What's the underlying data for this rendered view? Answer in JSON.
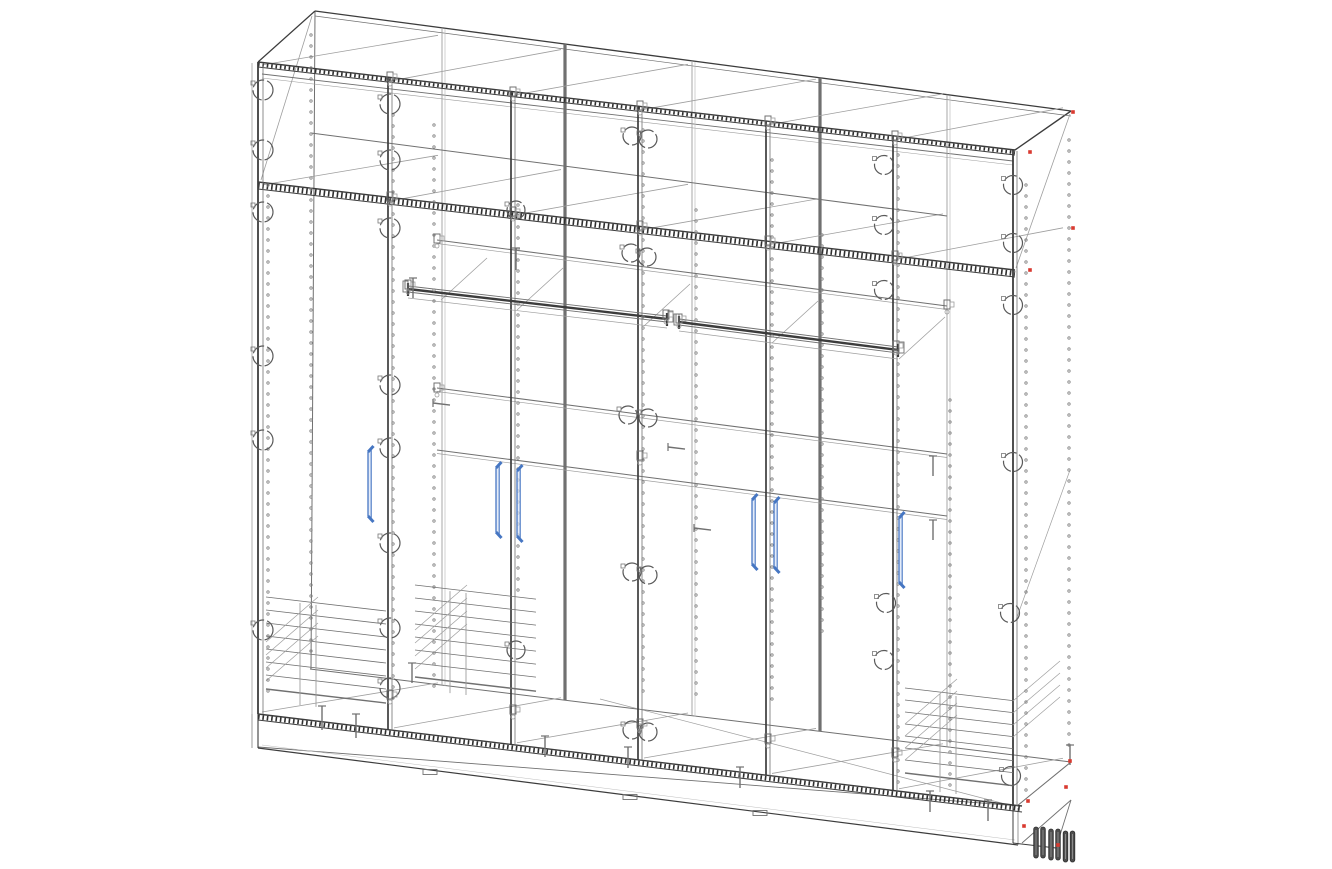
{
  "meta": {
    "kind": "cad-wireframe-drawing",
    "subject": "six-section wardrobe carcass, isometric wireframe view",
    "background": "#ffffff"
  },
  "palette": {
    "dark": "#3c3c3c",
    "mid": "#707070",
    "light": "#9e9e9e",
    "faint": "#bfbfbf",
    "hatch": "#2f2f2f",
    "blue": "#4676c2",
    "blue_fill": "#d8e4f6",
    "red": "#d93a30",
    "leg": "#4e4e4e",
    "leg_edge": "#2e2e2e"
  },
  "proj": {
    "x0": 258,
    "x1": 1015,
    "yTop": 62,
    "yMezz": 182,
    "yBot": 714,
    "yBase": 748,
    "sTop": 0.116,
    "sBot": 0.1205,
    "sBase": 0.128,
    "back": {
      "xL": 315,
      "yTL": 11,
      "xR": 1071,
      "yTR": 111,
      "yBL": 669,
      "yBR": 762
    }
  },
  "partitions": [
    390,
    513,
    640,
    768,
    895
  ],
  "back_edges": [
    {
      "x": 442,
      "w": 0.9,
      "double": true
    },
    {
      "x": 565,
      "w": 3.2,
      "double": false
    },
    {
      "x": 692,
      "w": 0.9,
      "double": true
    },
    {
      "x": 820,
      "w": 3.2,
      "double": false
    },
    {
      "x": 947,
      "w": 0.9,
      "double": true
    }
  ],
  "bands": [
    {
      "x1": 258,
      "y1": 62,
      "x2": 1015,
      "y2": 150,
      "gap": 5
    },
    {
      "x1": 258,
      "y1": 182,
      "x2": 1015,
      "y2": 270,
      "gap": 7
    },
    {
      "x1": 258,
      "y1": 714,
      "x2": 1022,
      "y2": 806,
      "gap": 6
    }
  ],
  "shelves": [
    {
      "x1": 437,
      "y1": 240,
      "x2": 947,
      "y2": 306,
      "double": true
    },
    {
      "x1": 437,
      "y1": 388,
      "x2": 947,
      "y2": 454,
      "double": true
    },
    {
      "x1": 437,
      "y1": 450,
      "x2": 947,
      "y2": 516,
      "double": true
    },
    {
      "x1": 311,
      "y1": 133,
      "x2": 947,
      "y2": 216,
      "double": false
    }
  ],
  "rails": [
    {
      "x1": 408,
      "y1": 289,
      "x2": 667,
      "y2": 319
    },
    {
      "x1": 679,
      "y1": 322,
      "x2": 898,
      "y2": 350
    }
  ],
  "extra_lines": [
    [
      252,
      63,
      252,
      714,
      0.8,
      "light"
    ],
    [
      315,
      11,
      311,
      669,
      1.0,
      "mid"
    ],
    [
      261,
      180,
      312,
      16,
      0.8,
      "light"
    ],
    [
      258,
      62,
      315,
      11,
      1.2,
      "dark"
    ],
    [
      1015,
      150,
      1071,
      111,
      1.4,
      "dark"
    ],
    [
      315,
      11,
      1071,
      111,
      1.3,
      "dark"
    ],
    [
      315,
      16,
      1071,
      116,
      0.7,
      "mid"
    ],
    [
      310,
      669,
      1071,
      762,
      1.0,
      "mid"
    ],
    [
      258,
      747,
      1020,
      806,
      0.9,
      "mid"
    ],
    [
      600,
      699,
      1013,
      806,
      0.7,
      "light"
    ],
    [
      1017,
      806,
      1071,
      762,
      1.1,
      "mid"
    ],
    [
      1022,
      843,
      1071,
      800,
      0.9,
      "mid"
    ],
    [
      1016,
      268,
      1070,
      114,
      0.8,
      "light"
    ],
    [
      1016,
      620,
      1070,
      470,
      0.7,
      "light"
    ],
    [
      262,
      74,
      1013,
      161,
      0.9,
      "mid"
    ],
    [
      262,
      78,
      1013,
      165,
      0.6,
      "light"
    ],
    [
      258,
      714,
      258,
      748,
      1.1,
      "dark"
    ],
    [
      252,
      714,
      252,
      748,
      0.7,
      "mid"
    ],
    [
      258,
      748,
      1018,
      845,
      1.2,
      "dark"
    ],
    [
      262,
      745,
      1015,
      840,
      0.5,
      "faint"
    ],
    [
      1013,
      806,
      1013,
      843,
      1.0,
      "dark"
    ],
    [
      1018,
      808,
      1018,
      845,
      0.7,
      "mid"
    ],
    [
      1013,
      843,
      1056,
      848,
      1.0,
      "dark"
    ],
    [
      1056,
      848,
      1071,
      800,
      0.9,
      "mid"
    ]
  ],
  "front_edges": [
    {
      "x": 258,
      "yA": 62,
      "yB": 714
    },
    {
      "x": 1013,
      "yA": 150,
      "yB": 806
    }
  ],
  "handles": [
    {
      "x": 368,
      "y1": 452,
      "y2": 516
    },
    {
      "x": 496,
      "y1": 468,
      "y2": 532
    },
    {
      "x": 517,
      "y1": 471,
      "y2": 536
    },
    {
      "x": 752,
      "y1": 500,
      "y2": 564
    },
    {
      "x": 774,
      "y1": 503,
      "y2": 567
    },
    {
      "x": 899,
      "y1": 518,
      "y2": 582
    }
  ],
  "circles": [
    [
      263,
      90,
      10
    ],
    [
      263,
      150,
      10
    ],
    [
      263,
      212,
      10
    ],
    [
      263,
      356,
      10
    ],
    [
      263,
      440,
      10
    ],
    [
      263,
      630,
      10
    ],
    [
      390,
      104,
      10
    ],
    [
      390,
      160,
      10
    ],
    [
      390,
      228,
      10
    ],
    [
      390,
      385,
      10
    ],
    [
      390,
      448,
      10
    ],
    [
      390,
      543,
      10
    ],
    [
      390,
      628,
      10
    ],
    [
      390,
      688,
      10
    ],
    [
      516,
      210,
      9
    ],
    [
      516,
      650,
      9
    ],
    [
      632,
      136,
      9
    ],
    [
      648,
      139,
      9
    ],
    [
      631,
      253,
      9
    ],
    [
      647,
      257,
      9
    ],
    [
      628,
      415,
      9
    ],
    [
      648,
      418,
      9
    ],
    [
      632,
      572,
      9
    ],
    [
      648,
      575,
      9
    ],
    [
      632,
      730,
      9
    ],
    [
      648,
      732,
      9
    ],
    [
      884,
      165,
      9.5
    ],
    [
      884,
      225,
      9.5
    ],
    [
      884,
      290,
      9.5
    ],
    [
      886,
      603,
      9.5
    ],
    [
      884,
      660,
      9.5
    ],
    [
      1013,
      185,
      9.5
    ],
    [
      1013,
      243,
      9.5
    ],
    [
      1013,
      305,
      9.5
    ],
    [
      1013,
      462,
      9.5
    ],
    [
      1010,
      613,
      9.5
    ],
    [
      1011,
      776,
      9.5
    ]
  ],
  "hole_columns": [
    [
      268,
      185,
      700
    ],
    [
      311,
      35,
      655
    ],
    [
      393,
      115,
      700
    ],
    [
      434,
      125,
      695
    ],
    [
      518,
      205,
      595
    ],
    [
      643,
      130,
      700
    ],
    [
      696,
      210,
      700
    ],
    [
      772,
      160,
      700
    ],
    [
      822,
      235,
      640
    ],
    [
      898,
      155,
      790
    ],
    [
      950,
      400,
      785
    ],
    [
      1026,
      185,
      790
    ],
    [
      1069,
      140,
      750
    ]
  ],
  "hole_step": 11,
  "pins_v": [
    [
      322,
      706,
      730
    ],
    [
      356,
      714,
      738
    ],
    [
      413,
      278,
      298
    ],
    [
      516,
      248,
      270
    ],
    [
      412,
      663,
      683
    ],
    [
      545,
      736,
      757
    ],
    [
      628,
      747,
      768
    ],
    [
      740,
      767,
      788
    ],
    [
      930,
      791,
      812
    ],
    [
      988,
      800,
      821
    ],
    [
      1070,
      745,
      765
    ],
    [
      933,
      456,
      476
    ],
    [
      933,
      520,
      540
    ]
  ],
  "pins_h": [
    [
      433,
      403,
      17
    ],
    [
      668,
      447,
      17
    ],
    [
      694,
      528,
      17
    ]
  ],
  "clips": [
    [
      430,
      772
    ],
    [
      630,
      797
    ],
    [
      760,
      813
    ]
  ],
  "fittings": [
    [
      390,
      77
    ],
    [
      513,
      92
    ],
    [
      640,
      106
    ],
    [
      768,
      121
    ],
    [
      895,
      136
    ],
    [
      390,
      197
    ],
    [
      513,
      212
    ],
    [
      640,
      226
    ],
    [
      768,
      241
    ],
    [
      895,
      256
    ],
    [
      408,
      285
    ],
    [
      666,
      315
    ],
    [
      679,
      319
    ],
    [
      896,
      346
    ],
    [
      437,
      239
    ],
    [
      947,
      305
    ],
    [
      437,
      388
    ],
    [
      640,
      456
    ],
    [
      390,
      695
    ],
    [
      513,
      710
    ],
    [
      640,
      724
    ],
    [
      768,
      739
    ],
    [
      895,
      753
    ]
  ],
  "braces_A": [
    [
      437,
      242
    ],
    [
      513,
      252
    ],
    [
      640,
      268
    ],
    [
      768,
      285
    ],
    [
      895,
      301
    ]
  ],
  "baskets": [
    {
      "x1": 266,
      "x2": 386,
      "y0": 597,
      "step": 13,
      "n": 7,
      "verts": [
        300,
        316
      ],
      "vlen": 102,
      "diags": 4,
      "dy0": 45
    },
    {
      "x1": 415,
      "x2": 536,
      "y0": 585,
      "step": 13,
      "n": 7,
      "verts": [
        450,
        466
      ],
      "vlen": 102,
      "diags": 4,
      "dy0": 45
    },
    {
      "x1": 905,
      "x2": 1013,
      "y0": 688,
      "step": 12,
      "n": 7,
      "verts": [
        940,
        956
      ],
      "vlen": 98,
      "diags": 4,
      "dy0": 36
    }
  ],
  "red_dots": [
    [
      1030,
      152
    ],
    [
      1073,
      112
    ],
    [
      1030,
      270
    ],
    [
      1073,
      228
    ],
    [
      1070,
      761
    ],
    [
      1066,
      787
    ],
    [
      1028,
      801
    ],
    [
      1024,
      826
    ],
    [
      1058,
      845
    ]
  ],
  "legs": {
    "xs": [
      1036,
      1043,
      1051,
      1058,
      1065.5,
      1072.5
    ],
    "ys": [
      827,
      827,
      829,
      829,
      831,
      831
    ],
    "h": 31,
    "w": 4.6
  }
}
